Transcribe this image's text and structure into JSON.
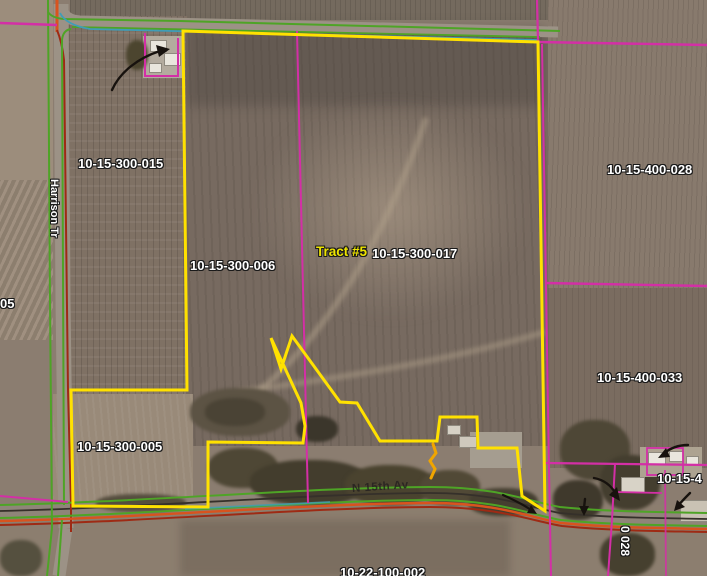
{
  "map": {
    "tract_label": "Tract #5",
    "parcel_labels": {
      "p_300_015": "10-15-300-015",
      "p_300_006": "10-15-300-006",
      "p_300_017": "10-15-300-017",
      "p_400_028": "10-15-400-028",
      "p_400_033": "10-15-400-033",
      "p_300_005": "10-15-300-005",
      "p_left_edge_partial": "05",
      "p_right_edge_partial": "10-15-4",
      "p_bottom_rotated_partial": "0 028",
      "p_bottom_edge_partial": "10-22-100-002"
    },
    "road_labels": {
      "harrison_trail": "Harrison Tr",
      "n_15th_av": "N 15th Av"
    },
    "colors": {
      "tract_boundary_yellow": "#ffe100",
      "parcel_line_magenta": "#d32fa6",
      "road_edge_green": "#4ea426",
      "road_line_teal": "#3f9db8",
      "section_line_orange": "#d9531e",
      "section_line_red": "#9e2a14",
      "road_centerline_dark": "#35302a",
      "annotation_black": "#17120e",
      "highlight_squiggle_orange": "#f0a500"
    }
  }
}
